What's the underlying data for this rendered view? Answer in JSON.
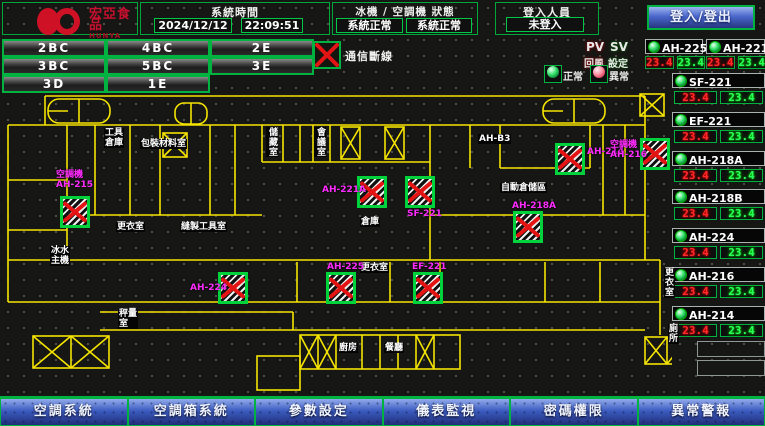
{
  "header": {
    "logo": {
      "brand_cn": "宏亞食品",
      "brand_en": "HUNYA FOODS"
    },
    "system_time": {
      "label": "系統時間",
      "date": "2024/12/12",
      "time": "22:09:51"
    },
    "status_panel": {
      "label": "冰機 / 空調機 狀態",
      "chiller_status": "系統正常",
      "ahu_status": "系統正常"
    },
    "login_panel": {
      "label": "登入人員",
      "value": "未登入"
    },
    "login_button": "登入/登出"
  },
  "floor_nav": [
    "2BC",
    "4BC",
    "2E",
    "3BC",
    "5BC",
    "3E",
    "3D",
    "1E"
  ],
  "comm_alert": "通信斷線",
  "legend": {
    "pv": "PV",
    "sv": "SV",
    "pv_name": "回風",
    "sv_name": "設定",
    "normal": "正常",
    "abnormal": "異常"
  },
  "colors": {
    "accent_green": "#00b341",
    "alarm_red": "#e41414",
    "pv_red": "#ff2a2a",
    "sv_green": "#2bff5e",
    "label_magenta": "#ff2bff",
    "wall_yellow": "#f5e400",
    "button_blue": "#3c5cc0"
  },
  "units": [
    {
      "name": "AH-225",
      "pv": "23.4",
      "sv": "23.4"
    },
    {
      "name": "AH-221A",
      "pv": "23.4",
      "sv": "23.4"
    },
    {
      "name": "SF-221",
      "pv": "23.4",
      "sv": "23.4"
    },
    {
      "name": "EF-221",
      "pv": "23.4",
      "sv": "23.4"
    },
    {
      "name": "AH-218A",
      "pv": "23.4",
      "sv": "23.4"
    },
    {
      "name": "AH-218B",
      "pv": "23.4",
      "sv": "23.4"
    },
    {
      "name": "AH-224",
      "pv": "23.4",
      "sv": "23.4"
    },
    {
      "name": "AH-216",
      "pv": "23.4",
      "sv": "23.4"
    },
    {
      "name": "AH-214",
      "pv": "23.4",
      "sv": "23.4"
    }
  ],
  "map": {
    "equipment": [
      {
        "label": "空調機\nAH-215",
        "x": 60,
        "y": 196,
        "lx": 56,
        "ly": 170
      },
      {
        "label": "AH-221A",
        "x": 357,
        "y": 176,
        "lx": 322,
        "ly": 185
      },
      {
        "label": "SF-221",
        "x": 405,
        "y": 176,
        "lx": 407,
        "ly": 209
      },
      {
        "label": "AH-214",
        "x": 555,
        "y": 143,
        "lx": 587,
        "ly": 147
      },
      {
        "label": "空調機\nAH-216",
        "x": 640,
        "y": 138,
        "lx": 610,
        "ly": 140
      },
      {
        "label": "AH-218A",
        "x": 513,
        "y": 211,
        "lx": 512,
        "ly": 201
      },
      {
        "label": "AH-224",
        "x": 218,
        "y": 272,
        "lx": 190,
        "ly": 283
      },
      {
        "label": "AH-225",
        "x": 326,
        "y": 272,
        "lx": 327,
        "ly": 262
      },
      {
        "label": "EF-221",
        "x": 413,
        "y": 272,
        "lx": 412,
        "ly": 262
      }
    ],
    "rooms": [
      {
        "label": "工具\n倉庫",
        "x": 104,
        "y": 128
      },
      {
        "label": "包裝材料室",
        "x": 140,
        "y": 139
      },
      {
        "label": "更衣室",
        "x": 116,
        "y": 222
      },
      {
        "label": "縫製工具室",
        "x": 180,
        "y": 222
      },
      {
        "label": "儲藏室",
        "x": 266,
        "y": 127,
        "vertical": true
      },
      {
        "label": "會議室",
        "x": 314,
        "y": 127,
        "vertical": true
      },
      {
        "label": "AH-B3",
        "x": 478,
        "y": 134
      },
      {
        "label": "自動倉儲區",
        "x": 500,
        "y": 183
      },
      {
        "label": "倉庫",
        "x": 360,
        "y": 217
      },
      {
        "label": "更衣室",
        "x": 360,
        "y": 263
      },
      {
        "label": "冰水\n主機",
        "x": 50,
        "y": 246
      },
      {
        "label": "秤量\n室",
        "x": 118,
        "y": 309
      },
      {
        "label": "廚房",
        "x": 338,
        "y": 343
      },
      {
        "label": "餐廳",
        "x": 384,
        "y": 343
      },
      {
        "label": "更衣室",
        "x": 664,
        "y": 268
      },
      {
        "label": "廁所",
        "x": 668,
        "y": 324
      }
    ]
  },
  "footer": [
    "空調系統",
    "空調箱系統",
    "參數設定",
    "儀表監視",
    "密碼權限",
    "異常警報"
  ]
}
